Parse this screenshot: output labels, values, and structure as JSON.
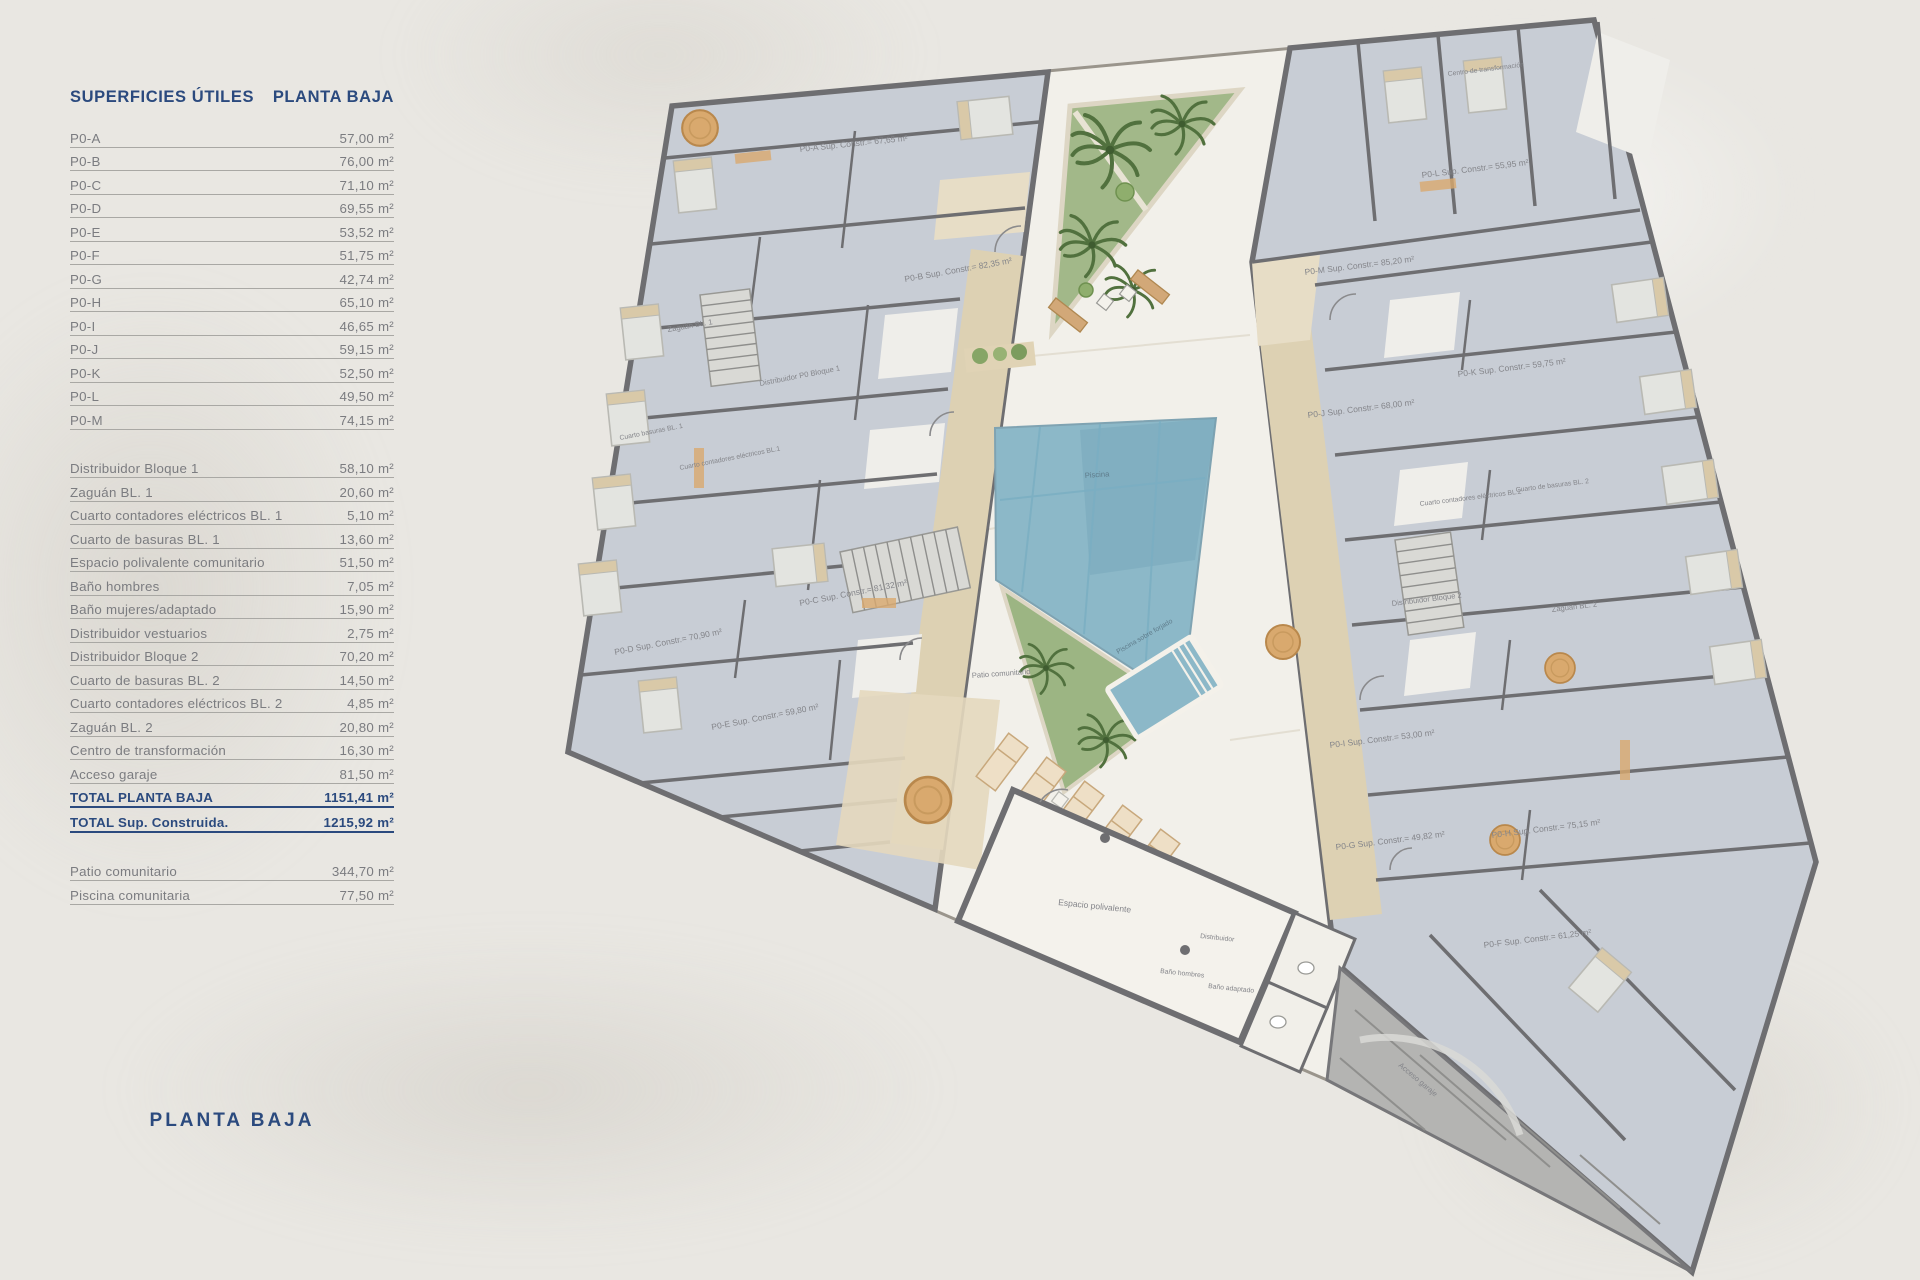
{
  "header": {
    "left": "SUPERFICIES ÚTILES",
    "right": "PLANTA BAJA"
  },
  "footer_title": "PLANTA BAJA",
  "colors": {
    "navy": "#2b4a7e",
    "text_gray": "#7b7c80",
    "wall": "#6e6e71",
    "pool": "#8cb8c8",
    "garden": "#a2b889",
    "corridor_tan": "#ddd1b3",
    "room_tile": "#c8cdd5",
    "paper": "#e9e7e2"
  },
  "table": {
    "units": [
      {
        "label": "P0-A",
        "value": "57,00 m²"
      },
      {
        "label": "P0-B",
        "value": "76,00 m²"
      },
      {
        "label": "P0-C",
        "value": "71,10 m²"
      },
      {
        "label": "P0-D",
        "value": "69,55 m²"
      },
      {
        "label": "P0-E",
        "value": "53,52 m²"
      },
      {
        "label": "P0-F",
        "value": "51,75 m²"
      },
      {
        "label": "P0-G",
        "value": "42,74 m²"
      },
      {
        "label": "P0-H",
        "value": "65,10 m²"
      },
      {
        "label": "P0-I",
        "value": "46,65 m²"
      },
      {
        "label": "P0-J",
        "value": "59,15 m²"
      },
      {
        "label": "P0-K",
        "value": "52,50 m²"
      },
      {
        "label": "P0-L",
        "value": "49,50 m²"
      },
      {
        "label": "P0-M",
        "value": "74,15 m²"
      }
    ],
    "commons": [
      {
        "label": "Distribuidor Bloque 1",
        "value": "58,10 m²"
      },
      {
        "label": "Zaguán BL. 1",
        "value": "20,60 m²"
      },
      {
        "label": "Cuarto contadores eléctricos BL. 1",
        "value": "5,10 m²"
      },
      {
        "label": "Cuarto de basuras BL. 1",
        "value": "13,60 m²"
      },
      {
        "label": "Espacio polivalente comunitario",
        "value": "51,50 m²"
      },
      {
        "label": "Baño hombres",
        "value": "7,05 m²"
      },
      {
        "label": "Baño mujeres/adaptado",
        "value": "15,90 m²"
      },
      {
        "label": "Distribuidor vestuarios",
        "value": "2,75 m²"
      },
      {
        "label": "Distribuidor Bloque 2",
        "value": "70,20 m²"
      },
      {
        "label": "Cuarto de basuras BL. 2",
        "value": "14,50 m²"
      },
      {
        "label": "Cuarto contadores eléctricos BL. 2",
        "value": "4,85 m²"
      },
      {
        "label": "Zaguán BL. 2",
        "value": "20,80 m²"
      },
      {
        "label": "Centro de transformación",
        "value": "16,30 m²"
      },
      {
        "label": "Acceso garaje",
        "value": "81,50 m²"
      },
      {
        "label": "TOTAL PLANTA BAJA",
        "value": "1151,41 m²",
        "cls": "total"
      },
      {
        "label": "TOTAL Sup. Construida.",
        "value": "1215,92 m²",
        "cls": "total"
      }
    ],
    "outdoor": [
      {
        "label": "Patio comunitario",
        "value": "344,70 m²"
      },
      {
        "label": "Piscina comunitaria",
        "value": "77,50 m²"
      }
    ]
  },
  "plan": {
    "labels": [
      "P0-A Sup. Constr.= 67,65 m²",
      "P0-B Sup. Constr.= 82,35 m²",
      "Zaguán BL. 1",
      "Distribuidor P0 Bloque 1",
      "Cuarto basuras BL. 1",
      "Cuarto contadores eléctricos BL.1",
      "P0-C Sup. Constr.= 81,32 m²",
      "P0-D Sup. Constr.= 70,90 m²",
      "P0-E Sup. Constr.= 59,80 m²",
      "Piscina",
      "Patio comunitario",
      "Piscina sobre forjado",
      "Espacio polivalente",
      "Distribuidor",
      "Baño hombres",
      "Baño adaptado",
      "Acceso garaje",
      "Centro de transformación",
      "P0-L Sup. Constr.= 55,95 m²",
      "P0-M Sup. Constr.= 85,20 m²",
      "P0-K Sup. Constr.= 59,75 m²",
      "P0-J Sup. Constr.= 68,00 m²",
      "Cuarto de basuras BL. 2",
      "Cuarto contadores eléctricos BL.2",
      "Distribuidor Bloque 2",
      "Zaguán BL. 2",
      "P0-I Sup. Constr.= 53,00 m²",
      "P0-G Sup. Constr.= 49,82 m²",
      "P0-H Sup. Constr.= 75,15 m²",
      "P0-F Sup. Constr.= 61,25 m²"
    ]
  }
}
